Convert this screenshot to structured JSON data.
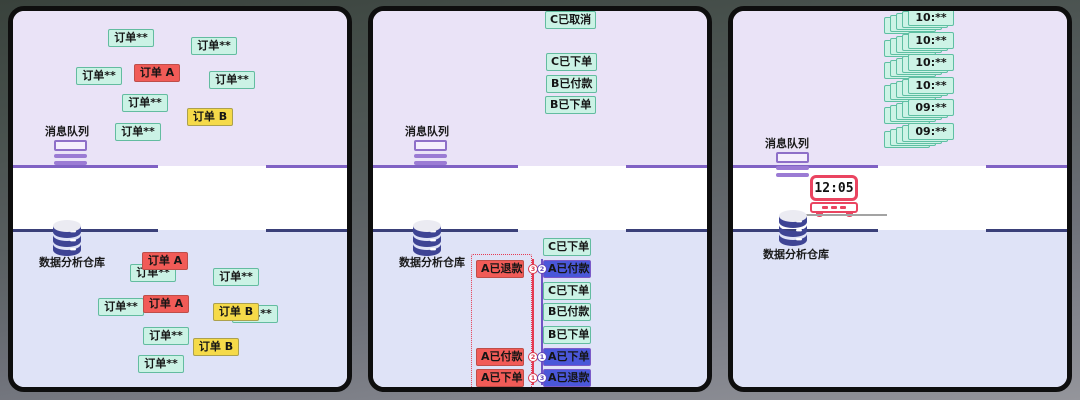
{
  "colors": {
    "panel_top_bg": "#eae3f7",
    "panel_middle_bg": "#ffffff",
    "panel_bottom_bg": "#dfe3f7",
    "queue_line": "#8062c4",
    "warehouse_line": "#3a4079",
    "tag_mint": "#cbf2e5",
    "tag_red": "#f15b57",
    "tag_yellow": "#f5da49",
    "tag_blue": "#4a57d9",
    "accent_red": "#e53b52",
    "accent_purple": "#7052c4",
    "clock_red": "#ea4460"
  },
  "panels": [
    {
      "queue_label": "消息队列",
      "warehouse_label": "数据分析仓库",
      "top_tags": [
        {
          "text": "订单**",
          "type": "mint",
          "x": 95,
          "y": 18
        },
        {
          "text": "订单**",
          "type": "mint",
          "x": 178,
          "y": 26
        },
        {
          "text": "订单**",
          "type": "mint",
          "x": 63,
          "y": 56
        },
        {
          "text": "订单 A",
          "type": "red",
          "x": 121,
          "y": 53
        },
        {
          "text": "订单**",
          "type": "mint",
          "x": 196,
          "y": 60
        },
        {
          "text": "订单**",
          "type": "mint",
          "x": 109,
          "y": 83
        },
        {
          "text": "订单 B",
          "type": "yellow",
          "x": 174,
          "y": 97
        },
        {
          "text": "订单**",
          "type": "mint",
          "x": 102,
          "y": 112
        }
      ],
      "bottom_tags": [
        {
          "text": "订单**",
          "type": "mint",
          "x": 117,
          "y": 253
        },
        {
          "text": "订单 A",
          "type": "red",
          "x": 129,
          "y": 241
        },
        {
          "text": "订单**",
          "type": "mint",
          "x": 200,
          "y": 257
        },
        {
          "text": "订单**",
          "type": "mint",
          "x": 85,
          "y": 287
        },
        {
          "text": "订单 A",
          "type": "red",
          "x": 130,
          "y": 284
        },
        {
          "text": "订单**",
          "type": "mint",
          "x": 219,
          "y": 294
        },
        {
          "text": "订单 B",
          "type": "yellow",
          "x": 200,
          "y": 292
        },
        {
          "text": "订单**",
          "type": "mint",
          "x": 130,
          "y": 316
        },
        {
          "text": "订单 B",
          "type": "yellow",
          "x": 180,
          "y": 327
        },
        {
          "text": "订单**",
          "type": "mint",
          "x": 125,
          "y": 344
        }
      ]
    },
    {
      "queue_label": "消息队列",
      "warehouse_label": "数据分析仓库",
      "top_tags": [
        {
          "text": "C已取消",
          "type": "mint",
          "x": 172,
          "y": 0
        },
        {
          "text": "C已下单",
          "type": "mint",
          "x": 173,
          "y": 42
        },
        {
          "text": "B已付款",
          "type": "mint",
          "x": 173,
          "y": 64
        },
        {
          "text": "B已下单",
          "type": "mint",
          "x": 172,
          "y": 85
        }
      ],
      "producer_tags": [
        {
          "text": "A已退款",
          "type": "red",
          "x": 103,
          "y": 249
        },
        {
          "text": "A已付款",
          "type": "red",
          "x": 103,
          "y": 337
        },
        {
          "text": "A已下单",
          "type": "red",
          "x": 103,
          "y": 358
        }
      ],
      "warehouse_column": [
        {
          "text": "C已下单",
          "type": "mint",
          "x": 170,
          "y": 227
        },
        {
          "text": "A已付款",
          "type": "blue",
          "x": 170,
          "y": 249
        },
        {
          "text": "C已下单",
          "type": "mint",
          "x": 170,
          "y": 271
        },
        {
          "text": "B已付款",
          "type": "mint",
          "x": 170,
          "y": 292
        },
        {
          "text": "B已下单",
          "type": "mint",
          "x": 170,
          "y": 315
        },
        {
          "text": "A已下单",
          "type": "blue",
          "x": 170,
          "y": 337
        },
        {
          "text": "A已退款",
          "type": "blue",
          "x": 170,
          "y": 358
        }
      ],
      "sequence_markers": [
        {
          "producer_seq": "3",
          "consumer_seq": "2",
          "cy": 258
        },
        {
          "producer_seq": "2",
          "consumer_seq": "1",
          "cy": 346
        },
        {
          "producer_seq": "1",
          "consumer_seq": "3",
          "cy": 367
        }
      ]
    },
    {
      "queue_label": "消息队列",
      "warehouse_label": "数据分析仓库",
      "clock_time": "12:05",
      "message_stacks": [
        {
          "text": "10:**",
          "x": 175,
          "y": -2
        },
        {
          "text": "10:**",
          "x": 175,
          "y": 21
        },
        {
          "text": "10:**",
          "x": 175,
          "y": 43
        },
        {
          "text": "10:**",
          "x": 175,
          "y": 66
        },
        {
          "text": "09:**",
          "x": 175,
          "y": 88
        },
        {
          "text": "09:**",
          "x": 175,
          "y": 112
        }
      ]
    }
  ]
}
